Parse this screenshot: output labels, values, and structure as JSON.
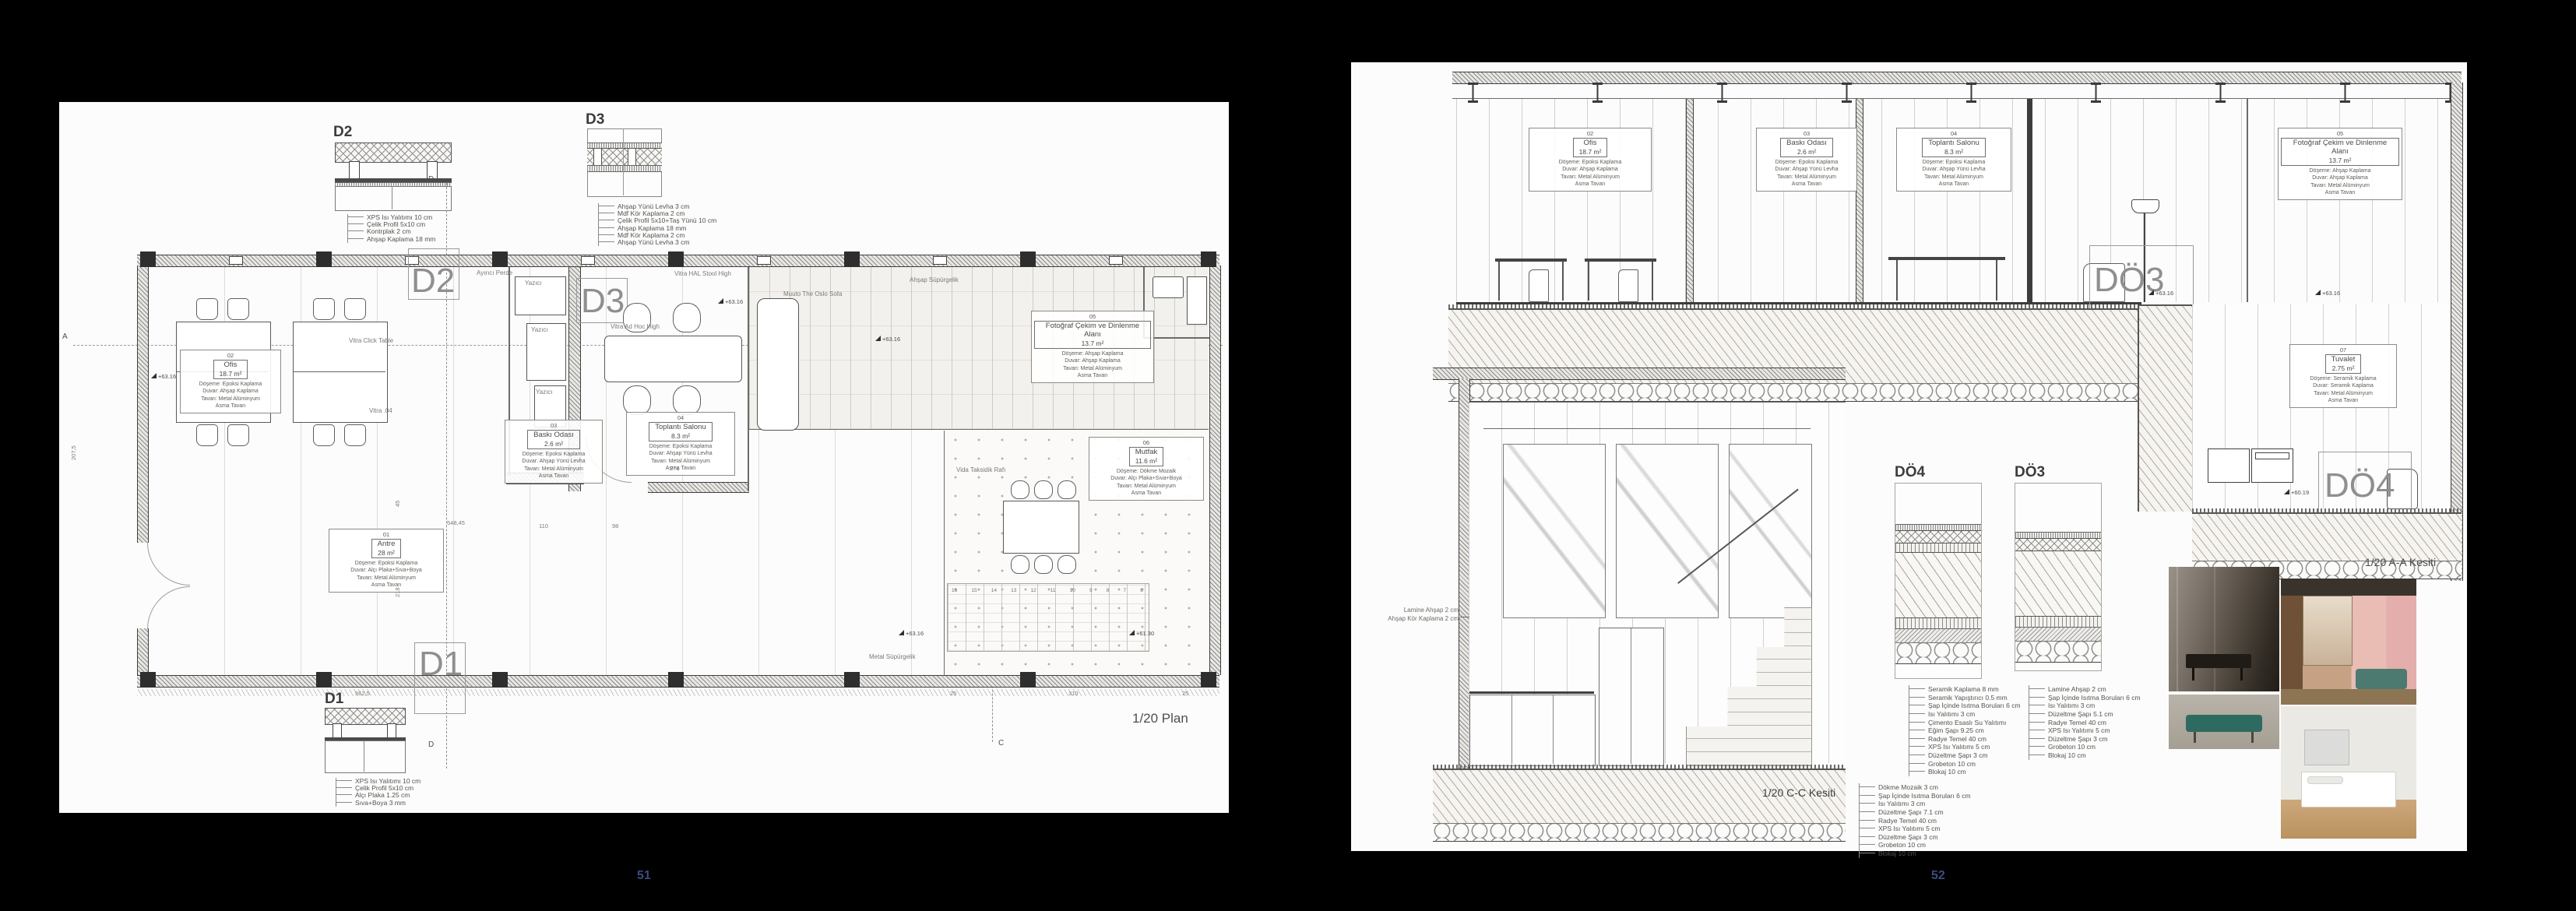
{
  "document": {
    "background": "#000000",
    "page_number_color": "#3e4c80",
    "left_page_number": "51",
    "right_page_number": "52"
  },
  "page51": {
    "scale_label": "1/20 Plan",
    "details": {
      "d2": {
        "label": "D2",
        "legend": [
          "XPS Isı Yalıtımı 10 cm",
          "Çelik Profil 5x10 cm",
          "Kontrplak 2 cm",
          "Ahşap Kaplama 18 mm"
        ]
      },
      "d3": {
        "label": "D3",
        "legend": [
          "Ahşap Yünü Levha 3 cm",
          "Mdf Kör Kaplama 2 cm",
          "Çelik Profil 5x10+Taş Yünü 10 cm",
          "Ahşap Kaplama 18 mm",
          "Mdf Kör Kaplama 2 cm",
          "Ahşap Yünü Levha 3 cm"
        ]
      },
      "d1": {
        "label": "D1",
        "legend": [
          "XPS Isı Yalıtımı 10 cm",
          "Çelik Profil 5x10 cm",
          "Alçı Plaka 1.25 cm",
          "Sıva+Boya 3 mm"
        ]
      }
    },
    "markers": {
      "d1": "D1",
      "d2": "D2",
      "d3": "D3"
    },
    "axes": {
      "a": "A",
      "b": "B",
      "c": "C",
      "d": "D"
    },
    "rooms": [
      {
        "number": "02",
        "name": "Ofis",
        "area": "18.7 m²",
        "finishes": [
          "Döşeme: Epoksi Kaplama",
          "Duvar: Ahşap Kaplama",
          "Tavan: Metal Alüminyum",
          "Asma Tavan"
        ]
      },
      {
        "number": "03",
        "name": "Baskı Odası",
        "area": "2.6 m²",
        "finishes": [
          "Döşeme: Epoksi Kaplama",
          "Duvar: Ahşap Yünü Levha",
          "Tavan: Metal Alüminyum",
          "Asma Tavan"
        ]
      },
      {
        "number": "04",
        "name": "Toplantı Salonu",
        "area": "8.3 m²",
        "finishes": [
          "Döşeme: Epoksi Kaplama",
          "Duvar: Ahşap Yünü Levha",
          "Tavan: Metal Alüminyum",
          "Asma Tavan"
        ]
      },
      {
        "number": "05",
        "name": "Fotoğraf Çekim ve Dinlenme Alanı",
        "area": "13.7 m²",
        "finishes": [
          "Döşeme: Ahşap Kaplama",
          "Duvar: Ahşap Kaplama",
          "Tavan: Metal Alüminyum",
          "Asma Tavan"
        ]
      },
      {
        "number": "06",
        "name": "Mutfak",
        "area": "11.6 m²",
        "finishes": [
          "Döşeme: Dökme Mozaik",
          "Duvar: Alçı Plaka+Sıva+Boya",
          "Tavan: Metal Alüminyum",
          "Asma Tavan"
        ]
      },
      {
        "number": "01",
        "name": "Antre",
        "area": "28 m²",
        "finishes": [
          "Döşeme: Epoksi Kaplama",
          "Duvar: Alçı Plaka+Sıva+Boya",
          "Tavan: Metal Alüminyum",
          "Asma Tavan"
        ]
      }
    ],
    "annotations": {
      "ayirici_perde": "Ayırıcı Perde",
      "vitra_click": "Vitra Click Table",
      "vitra_04": "Vitra .04",
      "vitra_hal": "Vitra HAL Stool High",
      "vitra_adhoc": "Vitra Ad Hoc High",
      "oslo_sofa": "Muuto The Oslo Sofa",
      "ahsap_supurgelik": "Ahşap Süpürgelik",
      "metal_supurgelik": "Metal Süpürgelik",
      "yazici": "Yazıcı",
      "raf": "Vida Taksidik Rafı"
    },
    "levels": {
      "l6316": "+63.16",
      "l6130": "+61.30"
    },
    "dims": {
      "d562": "562,5",
      "d548": "548,45",
      "d110": "110",
      "d98": "98",
      "d25": "25",
      "d310": "310",
      "d207": "207,5",
      "d218": "218",
      "d45": "45",
      "d271": "271"
    },
    "stairs": [
      "16",
      "15",
      "14",
      "13",
      "12",
      "11",
      "10",
      "9",
      "8",
      "7",
      "6"
    ]
  },
  "page52": {
    "section_aa_label": "1/20 A-A Kesiti",
    "section_cc_label": "1/20 C-C Kesiti",
    "markers": {
      "do3": "DÖ3",
      "do4": "DÖ4"
    },
    "rooms": [
      {
        "number": "02",
        "name": "Ofis",
        "area": "18.7 m²",
        "finishes": [
          "Döşeme: Epoksi Kaplama",
          "Duvar: Ahşap Kaplama",
          "Tavan: Metal Alüminyum",
          "Asma Tavan"
        ]
      },
      {
        "number": "03",
        "name": "Baskı Odası",
        "area": "2.6 m²",
        "finishes": [
          "Döşeme: Epoksi Kaplama",
          "Duvar: Ahşap Yünü Levha",
          "Tavan: Metal Alüminyum",
          "Asma Tavan"
        ]
      },
      {
        "number": "04",
        "name": "Toplantı Salonu",
        "area": "8.3 m²",
        "finishes": [
          "Döşeme: Epoksi Kaplama",
          "Duvar: Ahşap Yünü Levha",
          "Tavan: Metal Alüminyum",
          "Asma Tavan"
        ]
      },
      {
        "number": "05",
        "name": "Fotoğraf Çekim ve Dinlenme Alanı",
        "area": "13.7 m²",
        "finishes": [
          "Döşeme: Ahşap Kaplama",
          "Duvar: Ahşap Kaplama",
          "Tavan: Metal Alüminyum",
          "Asma Tavan"
        ]
      },
      {
        "number": "07",
        "name": "Tuvalet",
        "area": "2.75 m²",
        "finishes": [
          "Döşeme: Seramik Kaplama",
          "Duvar: Seramik Kaplama",
          "Tavan: Metal Alüminyum",
          "Asma Tavan"
        ]
      }
    ],
    "details": {
      "do4": {
        "label": "DÖ4",
        "legend": [
          "Seramik Kaplama 8 mm",
          "Seramik Yapıştırıcı 0.5 mm",
          "Şap İçinde Isıtma Boruları 6 cm",
          "Isı Yalıtımı 3 cm",
          "Çimento Esaslı Su Yalıtımı",
          "Eğim Şapı 9.25 cm",
          "Radye Temel 40 cm",
          "XPS Isı Yalıtımı 5 cm",
          "Düzeltme Şapı 3 cm",
          "Grobeton 10 cm",
          "Blokaj 10 cm"
        ]
      },
      "do3": {
        "label": "DÖ3",
        "legend": [
          "Lamine Ahşap 2 cm",
          "Şap İçinde Isıtma Boruları 6 cm",
          "Isı Yalıtımı 3 cm",
          "Düzeltme Şapı 5.1 cm",
          "Radye Temel 40 cm",
          "XPS Isı Yalıtımı 5 cm",
          "Düzeltme Şapı 3 cm",
          "Grobeton 10 cm",
          "Blokaj 10 cm"
        ]
      }
    },
    "floor_legend": [
      "Dökme Mozaik 3 cm",
      "Şap İçinde Isıtma Boruları 6 cm",
      "Isı Yalıtımı 3 cm",
      "Düzeltme Şapı 7.1 cm",
      "Radye Temel 40 cm",
      "XPS Isı Yalıtımı 5 cm",
      "Düzeltme Şapı 3 cm",
      "Grobeton 10 cm",
      "Blokaj 10 cm"
    ],
    "wall_note": [
      "Lamine Ahşap 2 cm",
      "Ahşap Kör Kaplama 2 cm"
    ],
    "levels": {
      "l6316": "+63.16",
      "l6019": "+60.19"
    }
  }
}
